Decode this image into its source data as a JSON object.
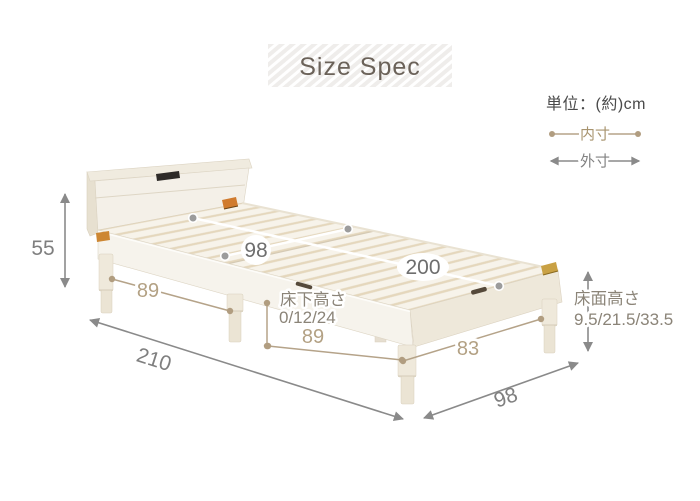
{
  "title": "Size Spec",
  "unit_note": "単位：(約)cm",
  "legend": {
    "inner_label": "内寸",
    "outer_label": "外寸"
  },
  "colors": {
    "inner_accent": "#b5a389",
    "outer_accent": "#8a8a8a",
    "title_text": "#6b6259",
    "label_gray": "#7f7f7f",
    "inner_label_gray": "#6e6e6e",
    "jp_note_gray": "#8b8478"
  },
  "measurements": {
    "headboard_height": "55",
    "inner_width": "98",
    "inner_length": "200",
    "outer_length": "210",
    "outer_width": "98",
    "head_leg_span": "89",
    "front_leg_span": "89",
    "foot_leg_span": "83",
    "under_bed_clearance": {
      "label": "床下高さ",
      "values": "0/12/24"
    },
    "floor_surface_height": {
      "label": "床面高さ",
      "values": "9.5/21.5/33.5"
    }
  }
}
